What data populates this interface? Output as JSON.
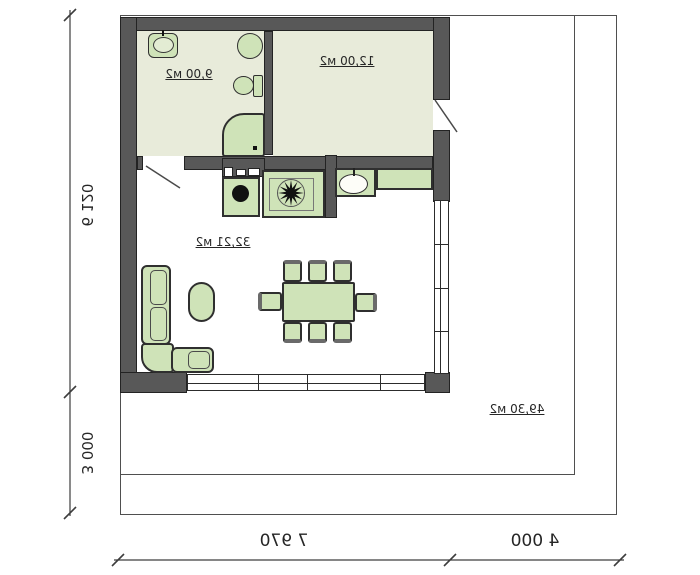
{
  "plan": {
    "type": "floor-plan",
    "mirrored": true,
    "rooms": [
      {
        "id": "bathroom",
        "area_label": "9,00 м2"
      },
      {
        "id": "bedroom",
        "area_label": "12,00 м2"
      },
      {
        "id": "living-room",
        "area_label": "32,21 м2"
      },
      {
        "id": "terrace",
        "area_label": "49,30 м2"
      }
    ],
    "dimensions": {
      "house_width": "7 970",
      "side_plot_width": "4 000",
      "house_depth": "6 120",
      "front_plot_depth": "3 000"
    },
    "fixtures": {
      "bathroom": [
        "washbasin",
        "round-fixture",
        "toilet",
        "shower"
      ],
      "kitchen": [
        "cabinet-strip",
        "washing-machine",
        "stove-burner",
        "kitchen-sink",
        "counter"
      ],
      "living_room": [
        "corner-sofa",
        "coffee-table",
        "dining-table"
      ],
      "dining_chairs": 8
    },
    "colors": {
      "wall": "#585858",
      "room_fill": "#e8ebda",
      "furniture": "#cfe3b8",
      "outline": "#232323",
      "line": "#3d3d3d",
      "text": "#262626"
    }
  }
}
